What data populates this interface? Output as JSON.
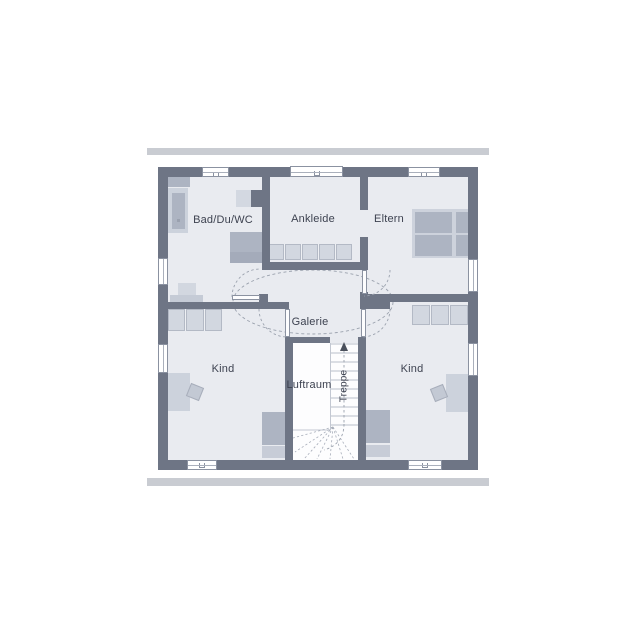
{
  "plan": {
    "rooms": [
      {
        "id": "bad-du-wc",
        "label": "Bad/Du/WC"
      },
      {
        "id": "ankleide",
        "label": "Ankleide"
      },
      {
        "id": "eltern",
        "label": "Eltern"
      },
      {
        "id": "galerie",
        "label": "Galerie"
      },
      {
        "id": "kind-links",
        "label": "Kind"
      },
      {
        "id": "kind-rechts",
        "label": "Kind"
      },
      {
        "id": "luftraum",
        "label": "Luftraum"
      },
      {
        "id": "treppe",
        "label": "Treppe"
      }
    ],
    "colors": {
      "wall": "#6e7585",
      "floor": "#e9ebf0",
      "roof_band": "#c9ccd2",
      "furniture_light": "#ccd2dc",
      "furniture_medium": "#adb4c2",
      "dashed_line": "#9aa1ad",
      "window": "#ffffff",
      "text": "#3d4250"
    }
  }
}
